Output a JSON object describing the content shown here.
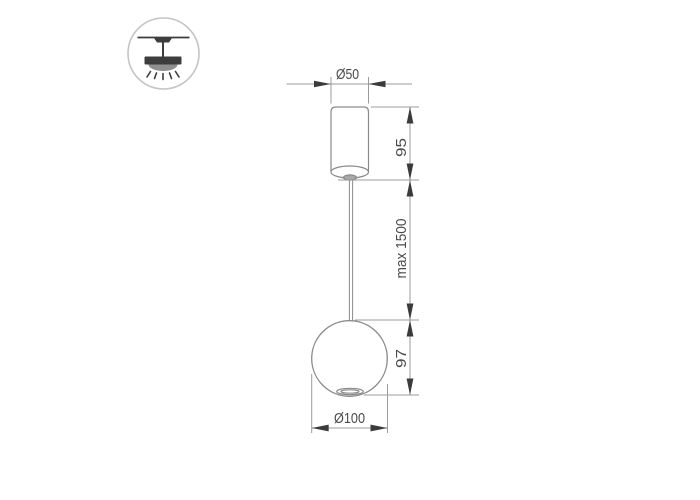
{
  "drawing": {
    "title": "pendant-lamp-dimension-drawing",
    "labels": {
      "top_diameter": "Ø50",
      "canopy_height": "95",
      "suspension_length": "max 1500",
      "sphere_height": "97",
      "sphere_diameter": "Ø100"
    },
    "icons": [
      {
        "name": "ceiling-pendant-mount-icon",
        "meaning": "surface ceiling mounted pendant luminaire"
      }
    ],
    "colors": {
      "background": "#ffffff",
      "object_outline": "#8a8a8a",
      "dimension_line": "#9b9b9b",
      "arrow": "#3b3b3b",
      "label_text": "#4a4a4a",
      "icon_dark": "#3d3d3d",
      "icon_dome": "#8f8f8f",
      "icon_circle": "#c4c4c4",
      "mount_fill": "#a8a8a8"
    }
  }
}
